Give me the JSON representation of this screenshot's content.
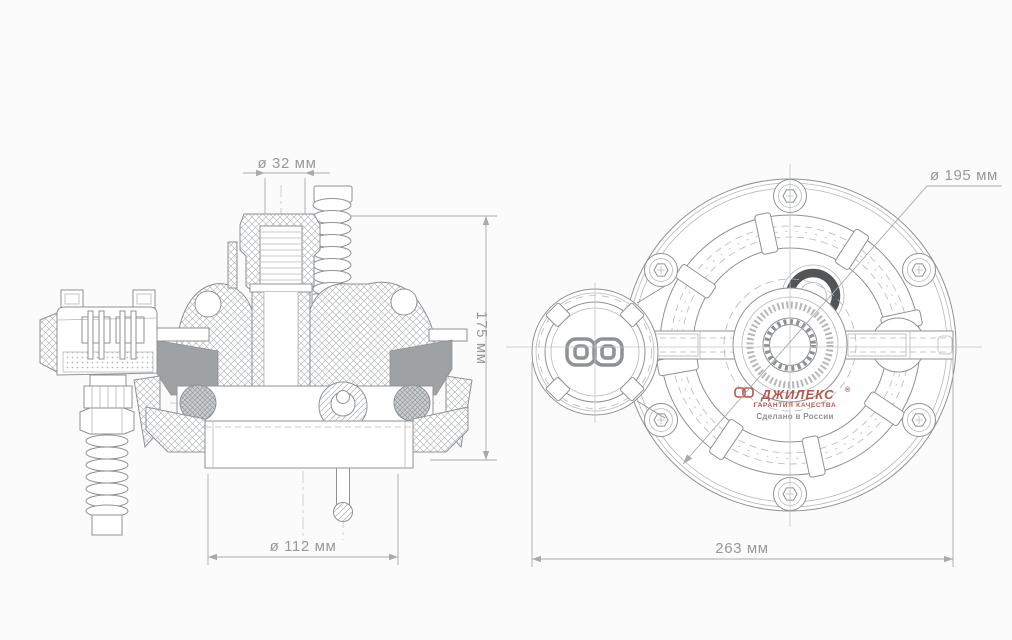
{
  "dimensions": {
    "inlet_diameter": "ø 32 мм",
    "height": "175 мм",
    "base_diameter": "ø 112 мм",
    "flange_diameter": "ø 195 мм",
    "overall_width": "263 мм"
  },
  "logo": {
    "brand": "ДЖИЛЕКС",
    "registered": "®",
    "tagline": "ГАРАНТИЯ КАЧЕСТВА",
    "made_in": "Сделано в России"
  },
  "colors": {
    "background": "#fbfbfb",
    "line": "#8e9296",
    "line_light": "#b5b8bb",
    "hatch": "#b7babd",
    "solid_fill": "#9ea2a5",
    "dim": "#a8abad",
    "dim_text": "#97999b",
    "centerline": "#c2c5c7",
    "logo_red": "#b4584e",
    "logo_gray": "#8f9396",
    "seal_dark": "#515558",
    "oring_fill": "#cbced0"
  }
}
